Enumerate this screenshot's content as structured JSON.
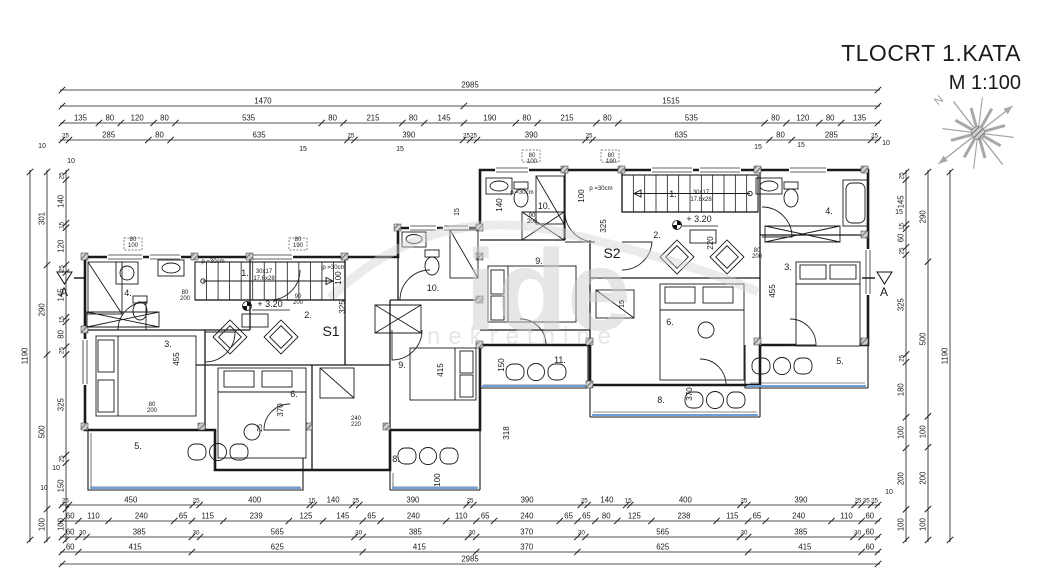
{
  "title": {
    "main": "TLOCRT 1.KATA",
    "scale": "M 1:100"
  },
  "plan": {
    "units": [
      "S1",
      "S2"
    ],
    "section_marker": "A",
    "north_label": "N"
  },
  "watermark": {
    "line1": "ide",
    "line2": "nekretnine"
  },
  "colors": {
    "line": "#1a1a1a",
    "terrace_edge": "#6f9fd8",
    "hatch": "#9a9a9a",
    "compass": "#a8a8a8",
    "watermark": "rgba(205,205,205,0.5)"
  },
  "dimensions": {
    "chains": [
      {
        "o": "h",
        "x": 62,
        "y": 90,
        "len": 816,
        "vals": [
          "2985"
        ]
      },
      {
        "o": "h",
        "x": 62,
        "y": 106,
        "len": 816,
        "vals": [
          "1470",
          "1515"
        ]
      },
      {
        "o": "h",
        "x": 62,
        "y": 123,
        "len": 816,
        "vals": [
          "135",
          "80",
          "120",
          "80",
          "535",
          "80",
          "215",
          "80",
          "145",
          "190",
          "80",
          "215",
          "80",
          "535",
          "80",
          "120",
          "80",
          "135"
        ]
      },
      {
        "o": "h",
        "x": 62,
        "y": 140,
        "len": 816,
        "vals": [
          "25",
          "285",
          "80",
          "635",
          "25",
          "390",
          "25",
          "25",
          "390",
          "25",
          "635",
          "80",
          "285",
          "25"
        ]
      },
      {
        "o": "h",
        "x": 62,
        "y": 505,
        "len": 816,
        "vals": [
          "25",
          "450",
          "25",
          "400",
          "15",
          "140",
          "25",
          "390",
          "25",
          "390",
          "25",
          "140",
          "15",
          "400",
          "25",
          "390",
          "25",
          "35",
          "25"
        ]
      },
      {
        "o": "h",
        "x": 62,
        "y": 521,
        "len": 816,
        "vals": [
          "60",
          "110",
          "240",
          "65",
          "115",
          "239",
          "125",
          "145",
          "65",
          "240",
          "110",
          "65",
          "240",
          "65",
          "65",
          "80",
          "125",
          "238",
          "115",
          "65",
          "240",
          "110",
          "60"
        ]
      },
      {
        "o": "h",
        "x": 62,
        "y": 537,
        "len": 816,
        "vals": [
          "60",
          "30",
          "385",
          "30",
          "565",
          "30",
          "385",
          "30",
          "370",
          "30",
          "565",
          "30",
          "385",
          "30",
          "60"
        ]
      },
      {
        "o": "h",
        "x": 62,
        "y": 552,
        "len": 816,
        "vals": [
          "60",
          "415",
          "625",
          "415",
          "370",
          "625",
          "415",
          "60"
        ]
      },
      {
        "o": "h",
        "x": 62,
        "y": 564,
        "len": 816,
        "vals": [
          "2985"
        ]
      },
      {
        "o": "v",
        "x": 30,
        "y": 172,
        "len": 368,
        "vals": [
          "1190"
        ]
      },
      {
        "o": "v",
        "x": 47,
        "y": 172,
        "len": 368,
        "vals": [
          "301",
          "290",
          "500",
          "100"
        ]
      },
      {
        "o": "v",
        "x": 66,
        "y": 172,
        "len": 368,
        "vals": [
          "25",
          "140",
          "15",
          "120",
          "25",
          "145",
          "15",
          "80",
          "25",
          "325",
          "25",
          "150",
          "100"
        ]
      },
      {
        "o": "v",
        "x": 906,
        "y": 172,
        "len": 368,
        "vals": [
          "25",
          "145",
          "15",
          "60",
          "25",
          "325",
          "25",
          "180",
          "100",
          "200",
          "100"
        ]
      },
      {
        "o": "v",
        "x": 928,
        "y": 172,
        "len": 368,
        "vals": [
          "290",
          "500",
          "100",
          "200",
          "100"
        ]
      },
      {
        "o": "v",
        "x": 950,
        "y": 172,
        "len": 368,
        "vals": [
          "1190"
        ]
      }
    ]
  },
  "labels": [
    {
      "t": "1.",
      "x": 245,
      "y": 276,
      "s": 9
    },
    {
      "t": "30x17",
      "x": 264,
      "y": 273,
      "s": 6
    },
    {
      "t": "17.6x28",
      "x": 264,
      "y": 280,
      "s": 6
    },
    {
      "t": "+ 3.20",
      "x": 270,
      "y": 307,
      "s": 9
    },
    {
      "t": "2.",
      "x": 308,
      "y": 318,
      "s": 9
    },
    {
      "t": "S1",
      "x": 331,
      "y": 336,
      "s": 14
    },
    {
      "t": "3.",
      "x": 168,
      "y": 347,
      "s": 9
    },
    {
      "t": "455",
      "x": 179,
      "y": 359,
      "s": 8,
      "r": -90
    },
    {
      "t": "4.",
      "x": 128,
      "y": 296,
      "s": 9
    },
    {
      "t": "5.",
      "x": 138,
      "y": 449,
      "s": 9
    },
    {
      "t": "6.",
      "x": 294,
      "y": 397,
      "s": 9
    },
    {
      "t": "370",
      "x": 283,
      "y": 410,
      "s": 8,
      "r": -90
    },
    {
      "t": "8.",
      "x": 396,
      "y": 462,
      "s": 9
    },
    {
      "t": "9.",
      "x": 402,
      "y": 368,
      "s": 9
    },
    {
      "t": "415",
      "x": 443,
      "y": 370,
      "s": 8,
      "r": -90
    },
    {
      "t": "10.",
      "x": 433,
      "y": 291,
      "s": 9
    },
    {
      "t": "11.",
      "x": 560,
      "y": 363,
      "s": 9
    },
    {
      "t": "318",
      "x": 509,
      "y": 433,
      "s": 8,
      "r": -90
    },
    {
      "t": "325",
      "x": 345,
      "y": 307,
      "s": 8,
      "r": -90
    },
    {
      "t": "100",
      "x": 341,
      "y": 278,
      "s": 8,
      "r": -90
    },
    {
      "t": "150",
      "x": 504,
      "y": 365,
      "s": 8,
      "r": -90
    },
    {
      "t": "100",
      "x": 440,
      "y": 480,
      "s": 8,
      "r": -90
    },
    {
      "t": "p =30cm",
      "x": 213,
      "y": 263,
      "s": 6
    },
    {
      "t": "p =30cm",
      "x": 334,
      "y": 269,
      "s": 6
    },
    {
      "t": "80\n200",
      "x": 185,
      "y": 294,
      "s": 6
    },
    {
      "t": "90\n200",
      "x": 298,
      "y": 298,
      "s": 6
    },
    {
      "t": "80\n200",
      "x": 152,
      "y": 406,
      "s": 6
    },
    {
      "t": "80\n100",
      "x": 133,
      "y": 241,
      "s": 6
    },
    {
      "t": "80\n190",
      "x": 298,
      "y": 241,
      "s": 6
    },
    {
      "t": "240\n220",
      "x": 356,
      "y": 420,
      "s": 6
    },
    {
      "t": "25",
      "x": 262,
      "y": 428,
      "s": 7,
      "r": -90
    },
    {
      "t": "1.",
      "x": 673,
      "y": 197,
      "s": 9
    },
    {
      "t": "30x17",
      "x": 701,
      "y": 194,
      "s": 6
    },
    {
      "t": "17.8x28",
      "x": 701,
      "y": 201,
      "s": 6
    },
    {
      "t": "+ 3.20",
      "x": 699,
      "y": 222,
      "s": 9
    },
    {
      "t": "2.",
      "x": 657,
      "y": 238,
      "s": 9
    },
    {
      "t": "S2",
      "x": 612,
      "y": 258,
      "s": 14
    },
    {
      "t": "3.",
      "x": 788,
      "y": 270,
      "s": 9
    },
    {
      "t": "455",
      "x": 775,
      "y": 291,
      "s": 8,
      "r": -90
    },
    {
      "t": "4.",
      "x": 829,
      "y": 214,
      "s": 9
    },
    {
      "t": "5.",
      "x": 840,
      "y": 364,
      "s": 9
    },
    {
      "t": "6.",
      "x": 670,
      "y": 325,
      "s": 9
    },
    {
      "t": "370",
      "x": 692,
      "y": 394,
      "s": 8,
      "r": -90
    },
    {
      "t": "8.",
      "x": 661,
      "y": 403,
      "s": 9
    },
    {
      "t": "9.",
      "x": 539,
      "y": 264,
      "s": 9
    },
    {
      "t": "10.",
      "x": 544,
      "y": 209,
      "s": 9
    },
    {
      "t": "325",
      "x": 606,
      "y": 226,
      "s": 8,
      "r": -90
    },
    {
      "t": "220",
      "x": 713,
      "y": 243,
      "s": 8,
      "r": -90
    },
    {
      "t": "140",
      "x": 502,
      "y": 205,
      "s": 8,
      "r": -90
    },
    {
      "t": "100",
      "x": 584,
      "y": 196,
      "s": 8,
      "r": -90
    },
    {
      "t": "p =30cm",
      "x": 601,
      "y": 190,
      "s": 6
    },
    {
      "t": "p =30cm",
      "x": 522,
      "y": 194,
      "s": 6
    },
    {
      "t": "80\n100",
      "x": 532,
      "y": 157,
      "s": 6
    },
    {
      "t": "80\n190",
      "x": 611,
      "y": 157,
      "s": 6
    },
    {
      "t": "80\n200",
      "x": 757,
      "y": 252,
      "s": 6
    },
    {
      "t": "90\n200",
      "x": 532,
      "y": 217,
      "s": 6
    },
    {
      "t": "15",
      "x": 459,
      "y": 212,
      "s": 7,
      "r": -90
    },
    {
      "t": "15",
      "x": 624,
      "y": 304,
      "s": 7,
      "r": -90
    },
    {
      "t": "A",
      "x": 64,
      "y": 296,
      "s": 12
    },
    {
      "t": "A",
      "x": 884,
      "y": 296,
      "s": 12
    },
    {
      "t": "N",
      "x": 941,
      "y": 103,
      "s": 11,
      "r": -40,
      "c": "#9a9a9a"
    },
    {
      "t": "10",
      "x": 42,
      "y": 148,
      "s": 7
    },
    {
      "t": "15",
      "x": 303,
      "y": 151,
      "s": 7
    },
    {
      "t": "15",
      "x": 400,
      "y": 151,
      "s": 7
    },
    {
      "t": "15",
      "x": 758,
      "y": 149,
      "s": 7
    },
    {
      "t": "15",
      "x": 801,
      "y": 147,
      "s": 7
    },
    {
      "t": "10",
      "x": 886,
      "y": 145,
      "s": 7
    },
    {
      "t": "10",
      "x": 44,
      "y": 490,
      "s": 7
    },
    {
      "t": "10",
      "x": 889,
      "y": 494,
      "s": 7
    },
    {
      "t": "10",
      "x": 56,
      "y": 470,
      "s": 7
    },
    {
      "t": "10",
      "x": 71,
      "y": 163,
      "s": 7
    },
    {
      "t": "15",
      "x": 899,
      "y": 214,
      "s": 7
    }
  ]
}
